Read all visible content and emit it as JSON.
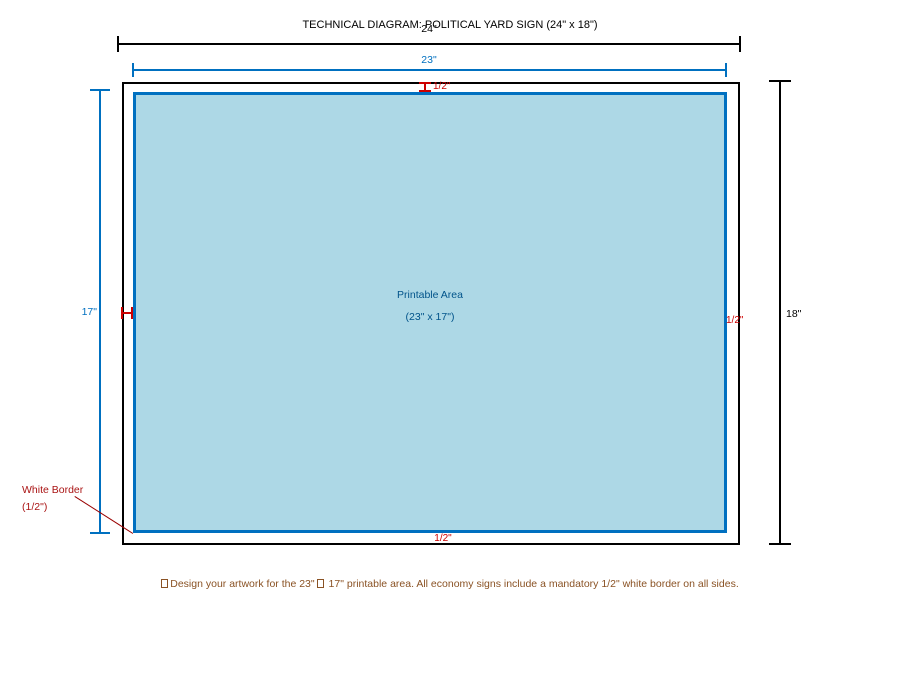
{
  "diagram": {
    "title": "TECHNICAL DIAGRAM: POLITICAL YARD SIGN (24\" x 18\")",
    "dimensions": {
      "outer_width_label": "24\"",
      "printable_width_label": "23\"",
      "printable_height_label": "17\"",
      "outer_height_label": "18\"",
      "border_top_label": "1/2\"",
      "border_left_marker": "half-inch gap marker",
      "border_right_label": "1/2\"",
      "border_bottom_label": "1/2\""
    },
    "printable_area": {
      "line1": "Printable Area",
      "line2": "(23\" x 17\")"
    },
    "callout": {
      "line1": "White Border",
      "line2": "(1/2\")"
    },
    "note": {
      "part1": "Design your artwork for the 23\"",
      "part2": "17\" printable area. All economy signs include a mandatory 1/2\" white border on all sides."
    },
    "icons": {
      "missing_glyph": "tofu-box (unrendered glyph placeholder)"
    },
    "colors": {
      "outline_black": "#000000",
      "dimension_blue": "#0070c0",
      "printable_fill": "#add8e6",
      "printable_text_blue": "#00538a",
      "marker_red": "#cc0000",
      "callout_red": "#aa1414",
      "note_brown": "#8a5224",
      "background": "#ffffff"
    }
  }
}
